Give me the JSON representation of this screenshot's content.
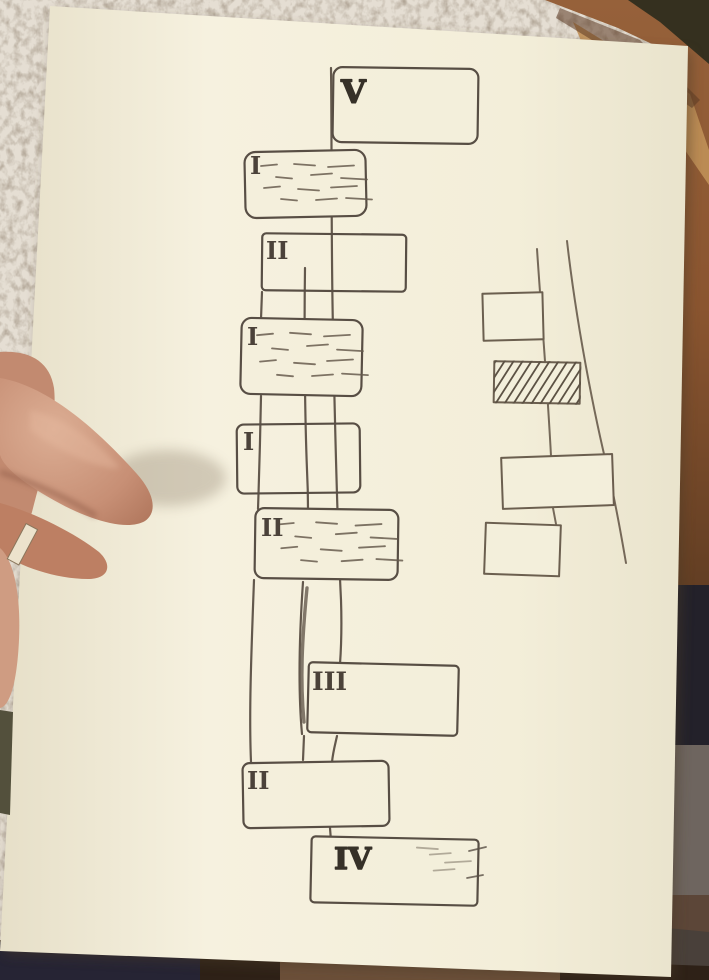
{
  "scene": {
    "description": "Photograph of a hand holding a sheet of paper with a hand-drawn flow/timeline sketch in pen",
    "colors": {
      "ink": "#4a4037",
      "paper": "#f4efdc",
      "carpet": "#a79a8a",
      "wood_floor": "#8f5a35",
      "skin": "#c9937b",
      "dark_floor": "#2e2117"
    }
  },
  "sketch": {
    "left_timeline": {
      "lane_count": 3,
      "boxes": [
        {
          "label": "V",
          "fill": "empty",
          "side": "right-of-line"
        },
        {
          "label": "I",
          "fill": "dash-shading",
          "side": "left-of-line"
        },
        {
          "label": "II",
          "fill": "empty",
          "side": "across-line"
        },
        {
          "label": "I",
          "fill": "dash-shading",
          "side": "left-of-line"
        },
        {
          "label": "I",
          "fill": "empty",
          "side": "left-of-line"
        },
        {
          "label": "II",
          "fill": "dash-shading",
          "side": "across-line"
        },
        {
          "label": "III",
          "fill": "empty",
          "side": "right-of-line"
        },
        {
          "label": "II",
          "fill": "empty",
          "side": "left-of-line"
        },
        {
          "label": "IV",
          "fill": "sparse-dashes",
          "side": "right-of-line"
        }
      ]
    },
    "right_timeline": {
      "lane_count": 2,
      "boxes": [
        {
          "label": "",
          "fill": "empty",
          "side": "left-of-line"
        },
        {
          "label": "",
          "fill": "hatched",
          "side": "across-line"
        },
        {
          "label": "",
          "fill": "empty",
          "side": "across-line"
        },
        {
          "label": "",
          "fill": "empty",
          "side": "left-of-line"
        }
      ]
    }
  }
}
